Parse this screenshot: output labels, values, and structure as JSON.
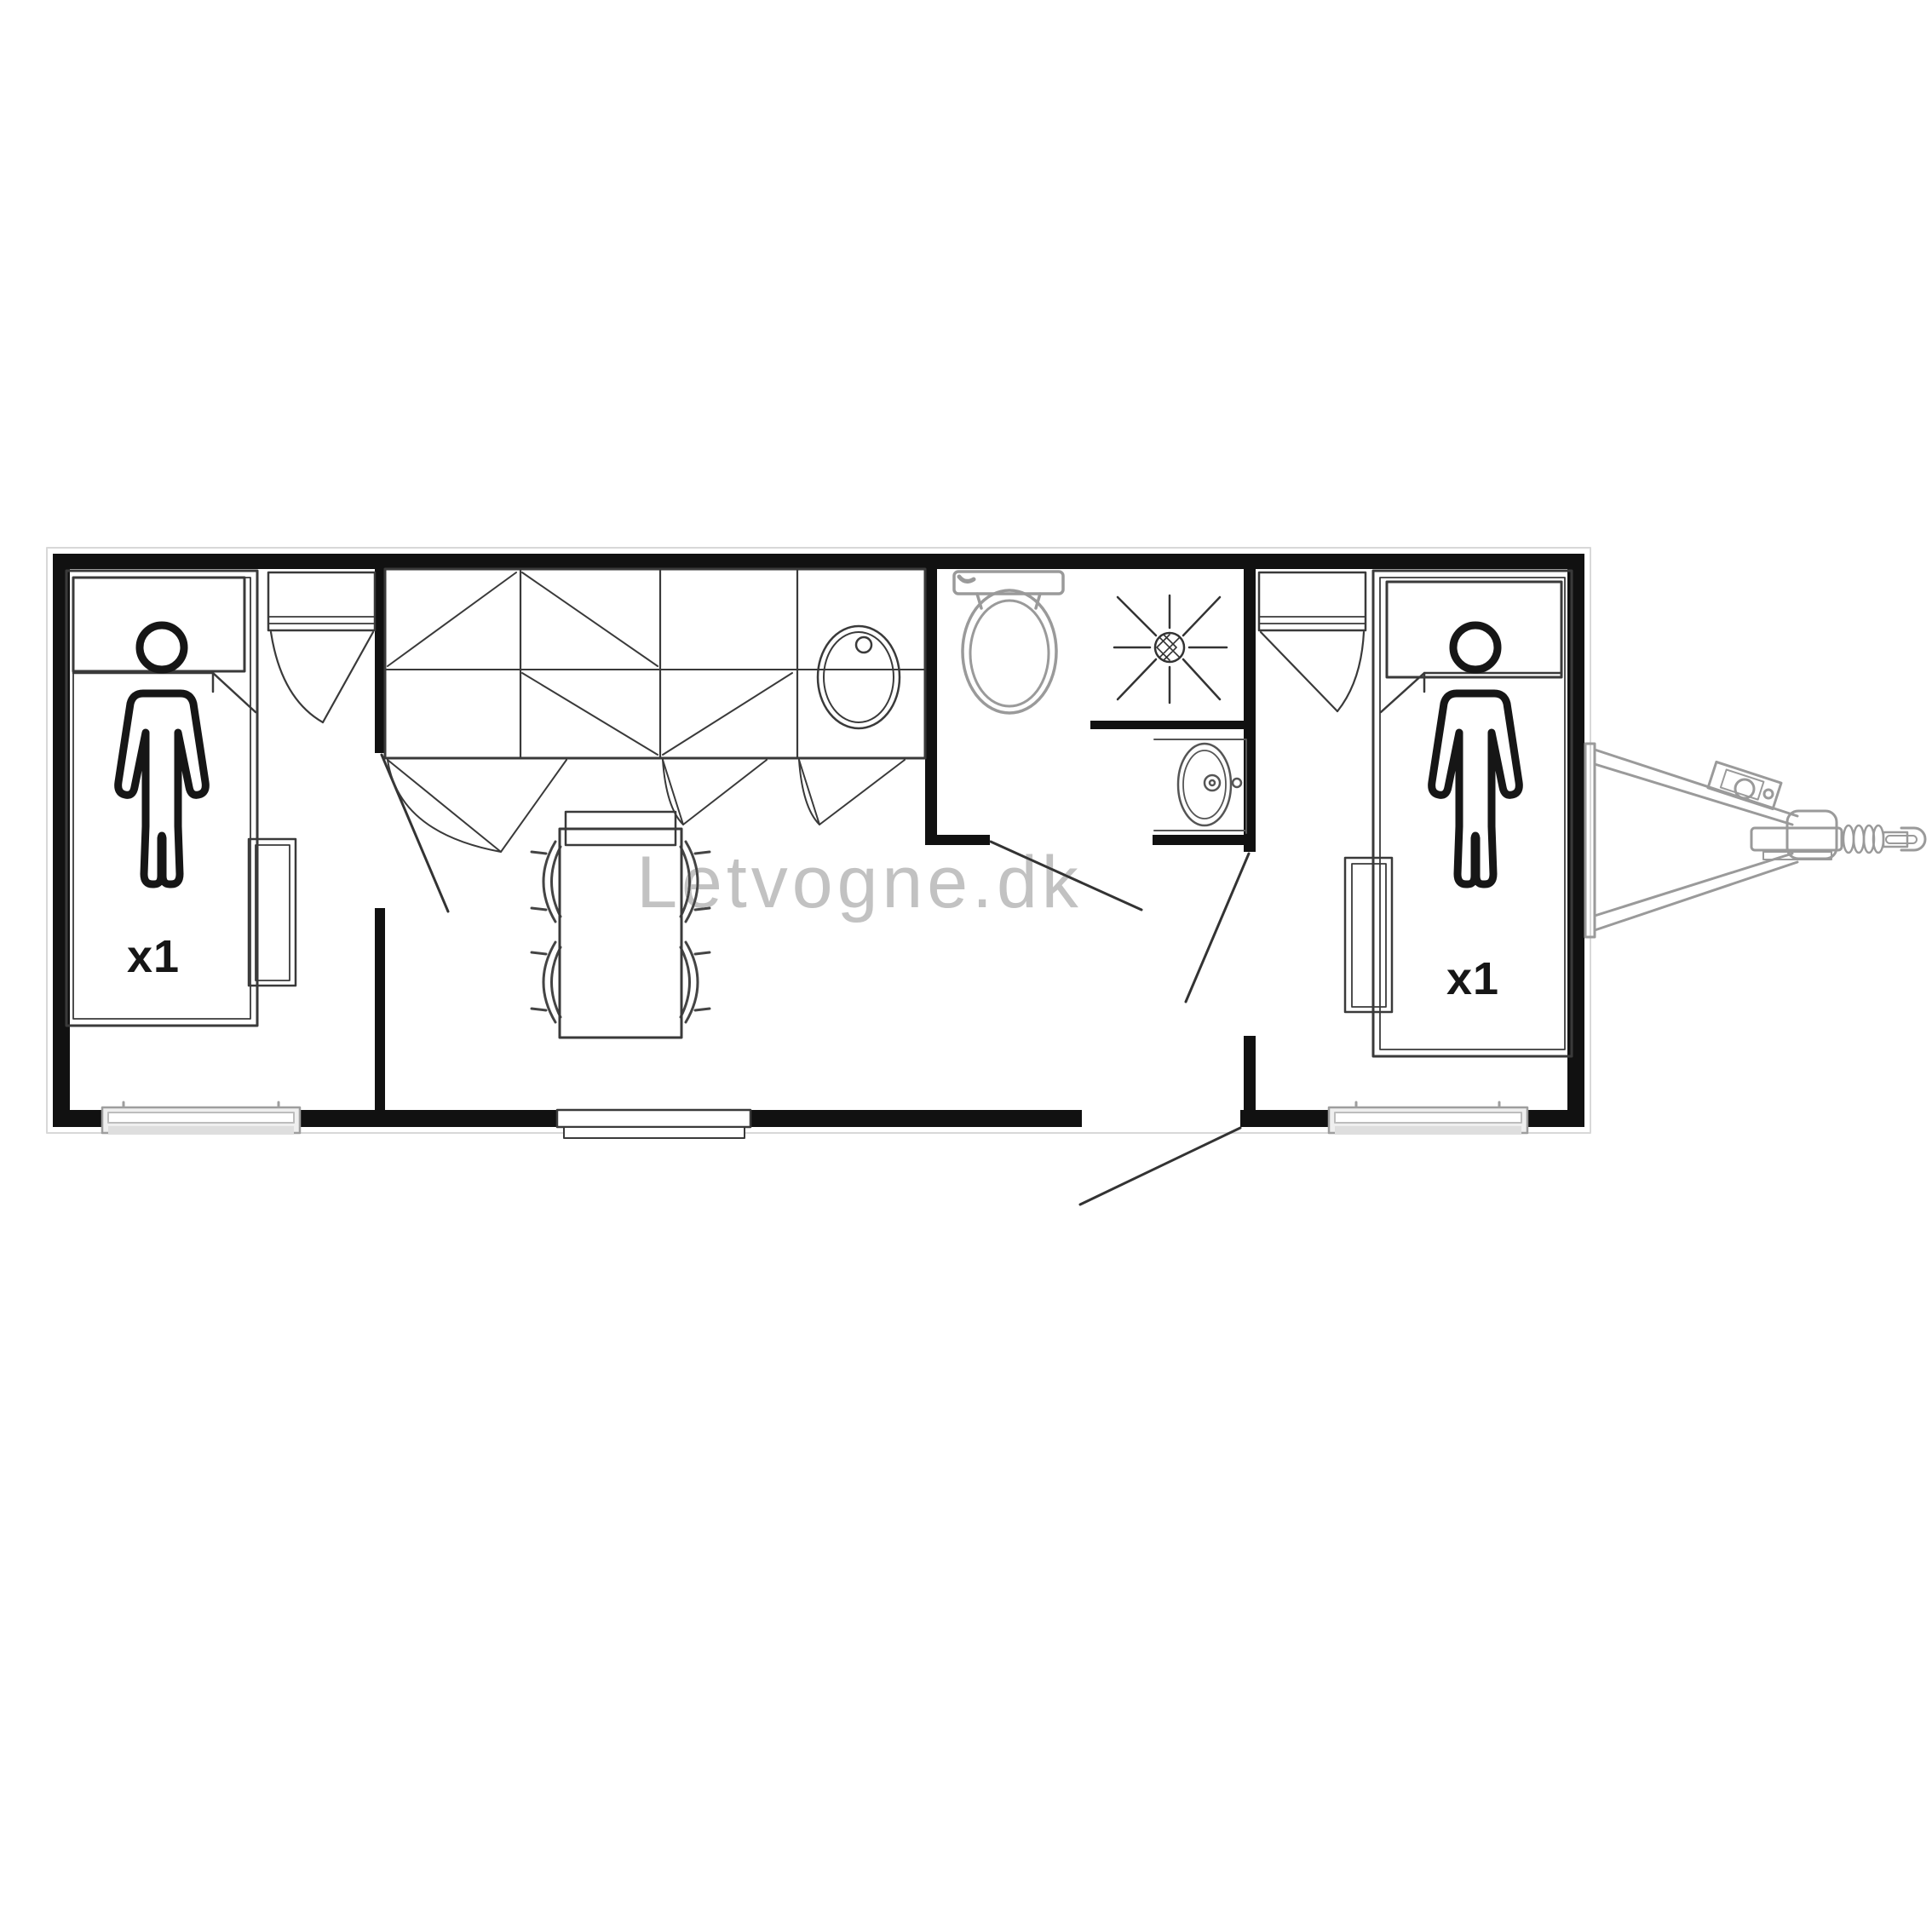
{
  "watermark": {
    "text": "Letvogne.dk",
    "color": "#c2c2c2"
  },
  "plan": {
    "bedroom_left": {
      "bed_capacity_label": "x1"
    },
    "bedroom_right": {
      "bed_capacity_label": "x1"
    },
    "colors": {
      "wall": "#111111",
      "furniture_line": "#3a3a3a",
      "fixture_gray": "#9a9a9a",
      "window_gray": "#efefef",
      "label": "#161616",
      "background": "#ffffff"
    },
    "icons": [
      "person-icon",
      "single-bed",
      "pillow",
      "wardrobe",
      "closet",
      "kitchen-counter",
      "kitchen-sink-icon",
      "cabinet-door-swing",
      "dining-table",
      "chair",
      "sideboard",
      "toilet-icon",
      "shower-icon",
      "shower-drain-icon",
      "washbasin-icon",
      "window",
      "entrance-door",
      "door-swing-line",
      "trailer-hitch-icon",
      "jockey-wheel-icon"
    ]
  }
}
